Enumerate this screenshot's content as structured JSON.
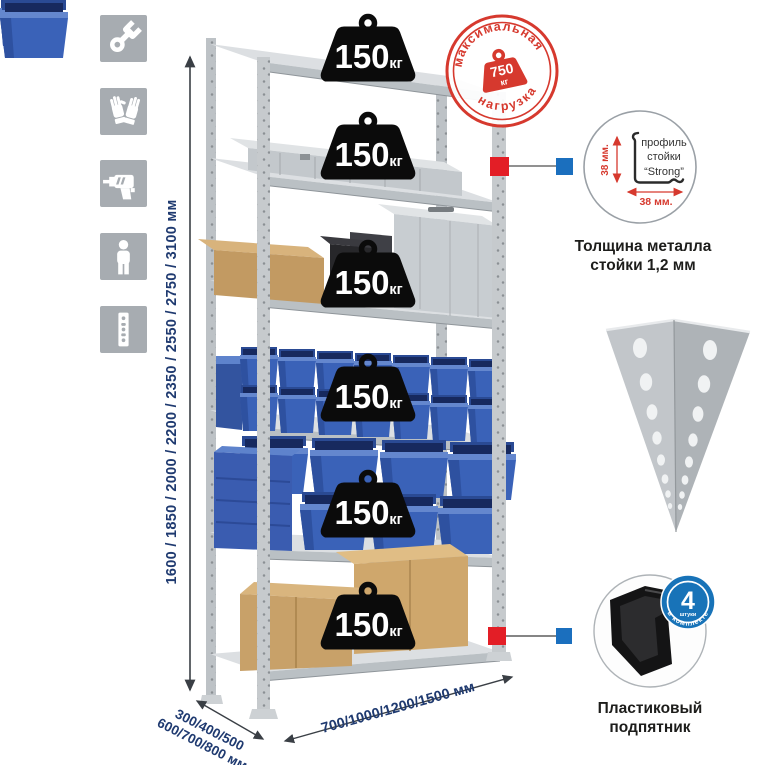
{
  "assembly_icons": [
    {
      "icon": "wrench-icon"
    },
    {
      "icon": "gloves-icon"
    },
    {
      "icon": "drill-icon"
    },
    {
      "icon": "person-icon"
    },
    {
      "icon": "perforated-profile-icon"
    }
  ],
  "rack": {
    "shelf_badges": [
      {
        "value": "150",
        "unit": "кг"
      },
      {
        "value": "150",
        "unit": "кг"
      },
      {
        "value": "150",
        "unit": "кг"
      },
      {
        "value": "150",
        "unit": "кг"
      },
      {
        "value": "150",
        "unit": "кг"
      },
      {
        "value": "150",
        "unit": "кг"
      }
    ],
    "height_options": "1600 / 1850 / 2000 / 2200 / 2350 / 2550 / 2750 / 3100 мм",
    "depth_options": "300/400/500\n600/700/800 мм",
    "width_options": "700/1000/1200/1500 мм"
  },
  "stamp": {
    "arc_top": "максимальная",
    "arc_bottom": "нагрузка",
    "value": "750",
    "unit": "кг"
  },
  "profile_callout": {
    "label_line1": "профиль",
    "label_line2": "стойки",
    "label_line3": "“Strong”",
    "dim_side": "38 мм.",
    "dim_bottom": "38 мм.",
    "caption": "Толщина металла\nстойки 1,2 мм"
  },
  "foot_callout": {
    "caption": "Пластиковый\nподпятник",
    "badge_count": "4",
    "badge_count_sub": "штуки",
    "badge_arc": "в комплекте"
  },
  "colors": {
    "stamp_red": "#d6392e",
    "marker_red": "#e31e26",
    "marker_blue": "#1b6fbe",
    "bin_blue": "#3a62b8",
    "text_navy": "#1f3a70",
    "badge_black": "#0b0b0b",
    "icon_gray": "#a7acb1"
  }
}
